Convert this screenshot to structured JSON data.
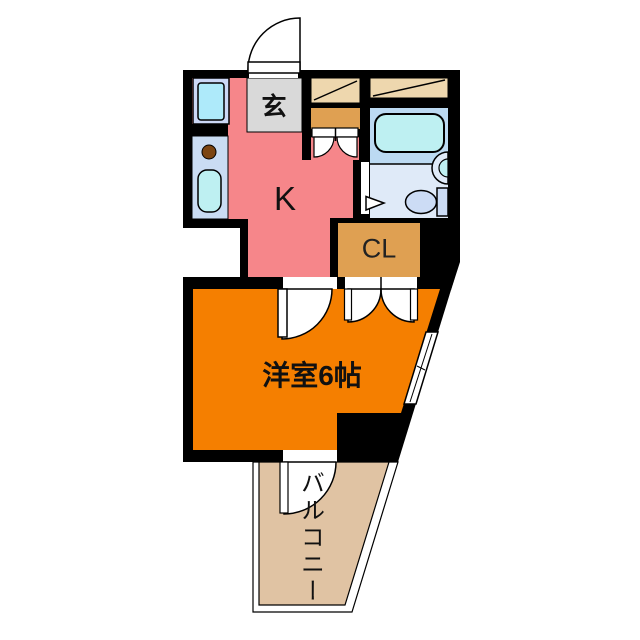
{
  "floorplan": {
    "labels": {
      "genkan": "玄",
      "kitchen": "K",
      "closet": "CL",
      "main_room": "洋室6帖",
      "balcony": "バルコニー"
    },
    "colors": {
      "wall_black": "#000000",
      "kitchen_pink": "#f6868a",
      "genkan_gray": "#d9d9d9",
      "storage_tan": "#eed7ae",
      "closet_orange": "#dfa052",
      "room_orange": "#f57f00",
      "balcony_tan": "#e0c3a3",
      "bath_upper_blue": "#bcdaf2",
      "bath_lower_blue": "#dfeaf8",
      "tub_cyan": "#bef0f2",
      "fixture_blue": "#ccdcf5",
      "counter_blue": "#cadcf3",
      "pan_frame_blue": "#ccd8f6",
      "pan_inner_cyan": "#aeeafa",
      "burner_brown": "#7c4512"
    }
  }
}
